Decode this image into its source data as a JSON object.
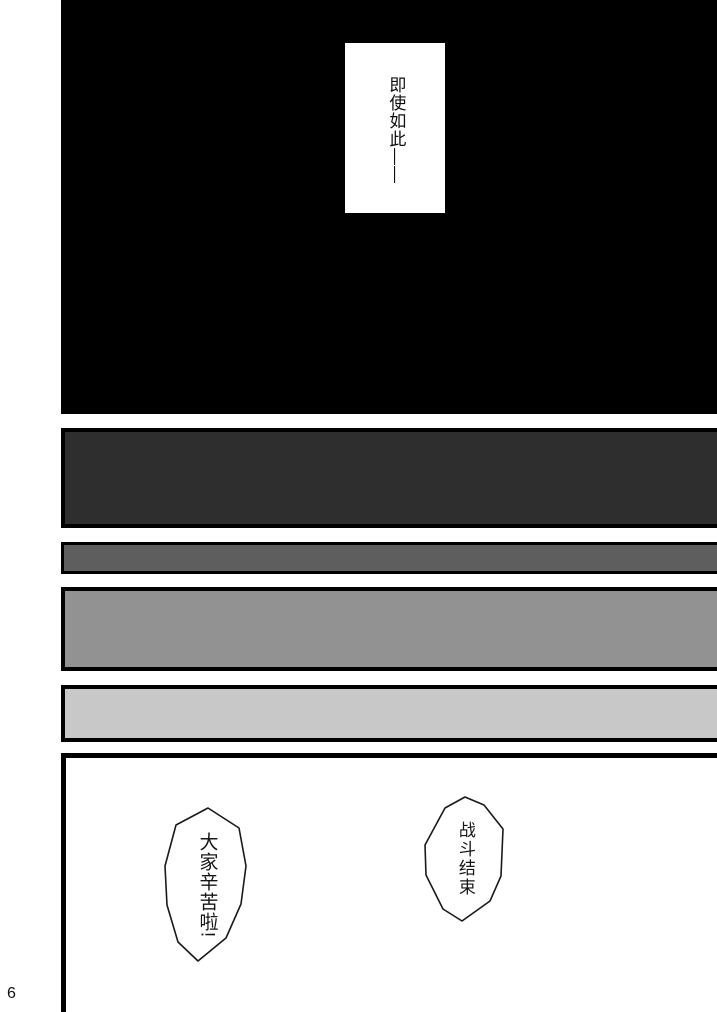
{
  "page_number": "6",
  "panels": {
    "top": {
      "narration": "即使如此——"
    },
    "bottom": {
      "bubble_battle": "战斗结束",
      "bubble_thanks": "大家辛苦啦!"
    }
  },
  "colors": {
    "ink": "#000000",
    "paper": "#ffffff",
    "panel_dark": "#2e2e2e",
    "bar_medium": "#5e5e5e",
    "panel_mid": "#929292",
    "bar_light": "#c8c8c8"
  }
}
